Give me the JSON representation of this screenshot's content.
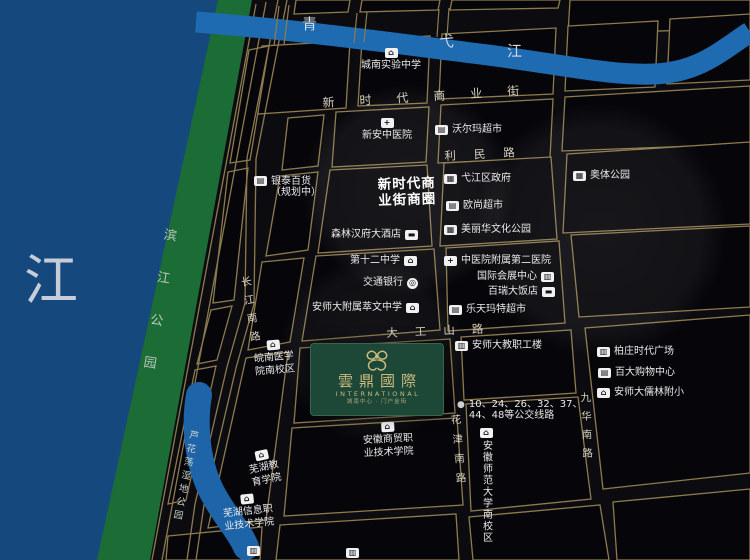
{
  "colors": {
    "background": "#0c0c10",
    "block_fill": "#06060a",
    "road_line": "#8d7b4f",
    "river_left": "#15497d",
    "river_top": "#1e6bb2",
    "pond": "#1d64a9",
    "park_green": "#1b6c35",
    "brand_green": "#1d4838",
    "brand_gold": "#cbb97e",
    "poi_text": "#eaeaea",
    "road_text": "#d8d0bd"
  },
  "icon_glyphs": {
    "school": "⌂",
    "hospital": "+",
    "store": "▤",
    "government": "▦",
    "park": "▦",
    "hotel": "▬",
    "bank": "◎",
    "building": "▥",
    "bus": "●"
  },
  "project": {
    "name": "雲鼎國際",
    "name_en": "INTERNATIONAL",
    "tagline": "城南中心 · 门户金街"
  },
  "rivers": {
    "left": "江",
    "top_chars": [
      "青",
      "弋",
      "江"
    ]
  },
  "parks": {
    "riverside": "滨江公园",
    "wetland": "芦花荡湿地公园"
  },
  "business_circle": {
    "line1": "新时代商",
    "line2": "业街商圈"
  },
  "roads": {
    "xinshidai": "新时代商业街",
    "limin": "利民路",
    "dagongshan": "大工山路",
    "changjiang": "长江南路",
    "huajin": "花津南路",
    "jiuhua": "九华南路"
  },
  "bus": {
    "line1": "10、24、26、32、37、",
    "line2": "44、48等公交线路"
  },
  "pois": {
    "chengnan_middle": {
      "text": "城南实验中学",
      "icon": "school"
    },
    "xinan_hospital": {
      "text": "新安中医院",
      "icon": "hospital"
    },
    "walmart": {
      "text": "沃尔玛超市",
      "icon": "store"
    },
    "yintai": {
      "line1": "银泰百货",
      "line2": "（规划中）",
      "icon": "store"
    },
    "yijiang_gov": {
      "text": "弋江区政府",
      "icon": "government"
    },
    "auchan": {
      "text": "欧尚超市",
      "icon": "store"
    },
    "meilihua_park": {
      "text": "美丽华文化公园",
      "icon": "park"
    },
    "aoti_park": {
      "text": "奥体公园",
      "icon": "park"
    },
    "senlin_hotel": {
      "text": "森林汉府大酒店",
      "icon": "hotel"
    },
    "no12_middle": {
      "text": "第十二中学",
      "icon": "school"
    },
    "zhongyiyuan_2": {
      "text": "中医院附属第二医院",
      "icon": "hospital"
    },
    "convention": {
      "text": "国际会展中心",
      "icon": "building"
    },
    "bairui_hotel": {
      "text": "百瑞大饭店",
      "icon": "hotel"
    },
    "bocom": {
      "text": "交通银行",
      "icon": "bank"
    },
    "cuiwen_middle": {
      "text": "安师大附属萃文中学",
      "icon": "school"
    },
    "lotte_mart": {
      "text": "乐天玛特超市",
      "icon": "store"
    },
    "ashida_staff": {
      "text": "安师大教职工楼",
      "icon": "building"
    },
    "baizhuang_plaza": {
      "text": "柏庄时代广场",
      "icon": "building"
    },
    "baida_mall": {
      "text": "百大购物中心",
      "icon": "store"
    },
    "rulin_primary": {
      "text": "安师大儒林附小",
      "icon": "school"
    },
    "wannan_medical": {
      "line1": "皖南医学",
      "line2": "院南校区",
      "icon": "school"
    },
    "wuhu_edu": {
      "line1": "芜湖教",
      "line2": "育学院",
      "icon": "school"
    },
    "wuhu_info": {
      "line1": "芜湖信息职",
      "line2": "业技术学院",
      "icon": "school"
    },
    "anhui_business": {
      "line1": "安徽商贸职",
      "line2": "业技术学院",
      "icon": "school"
    },
    "anhui_normal": {
      "text": "安徽师范大学南校区",
      "icon": "school"
    }
  }
}
